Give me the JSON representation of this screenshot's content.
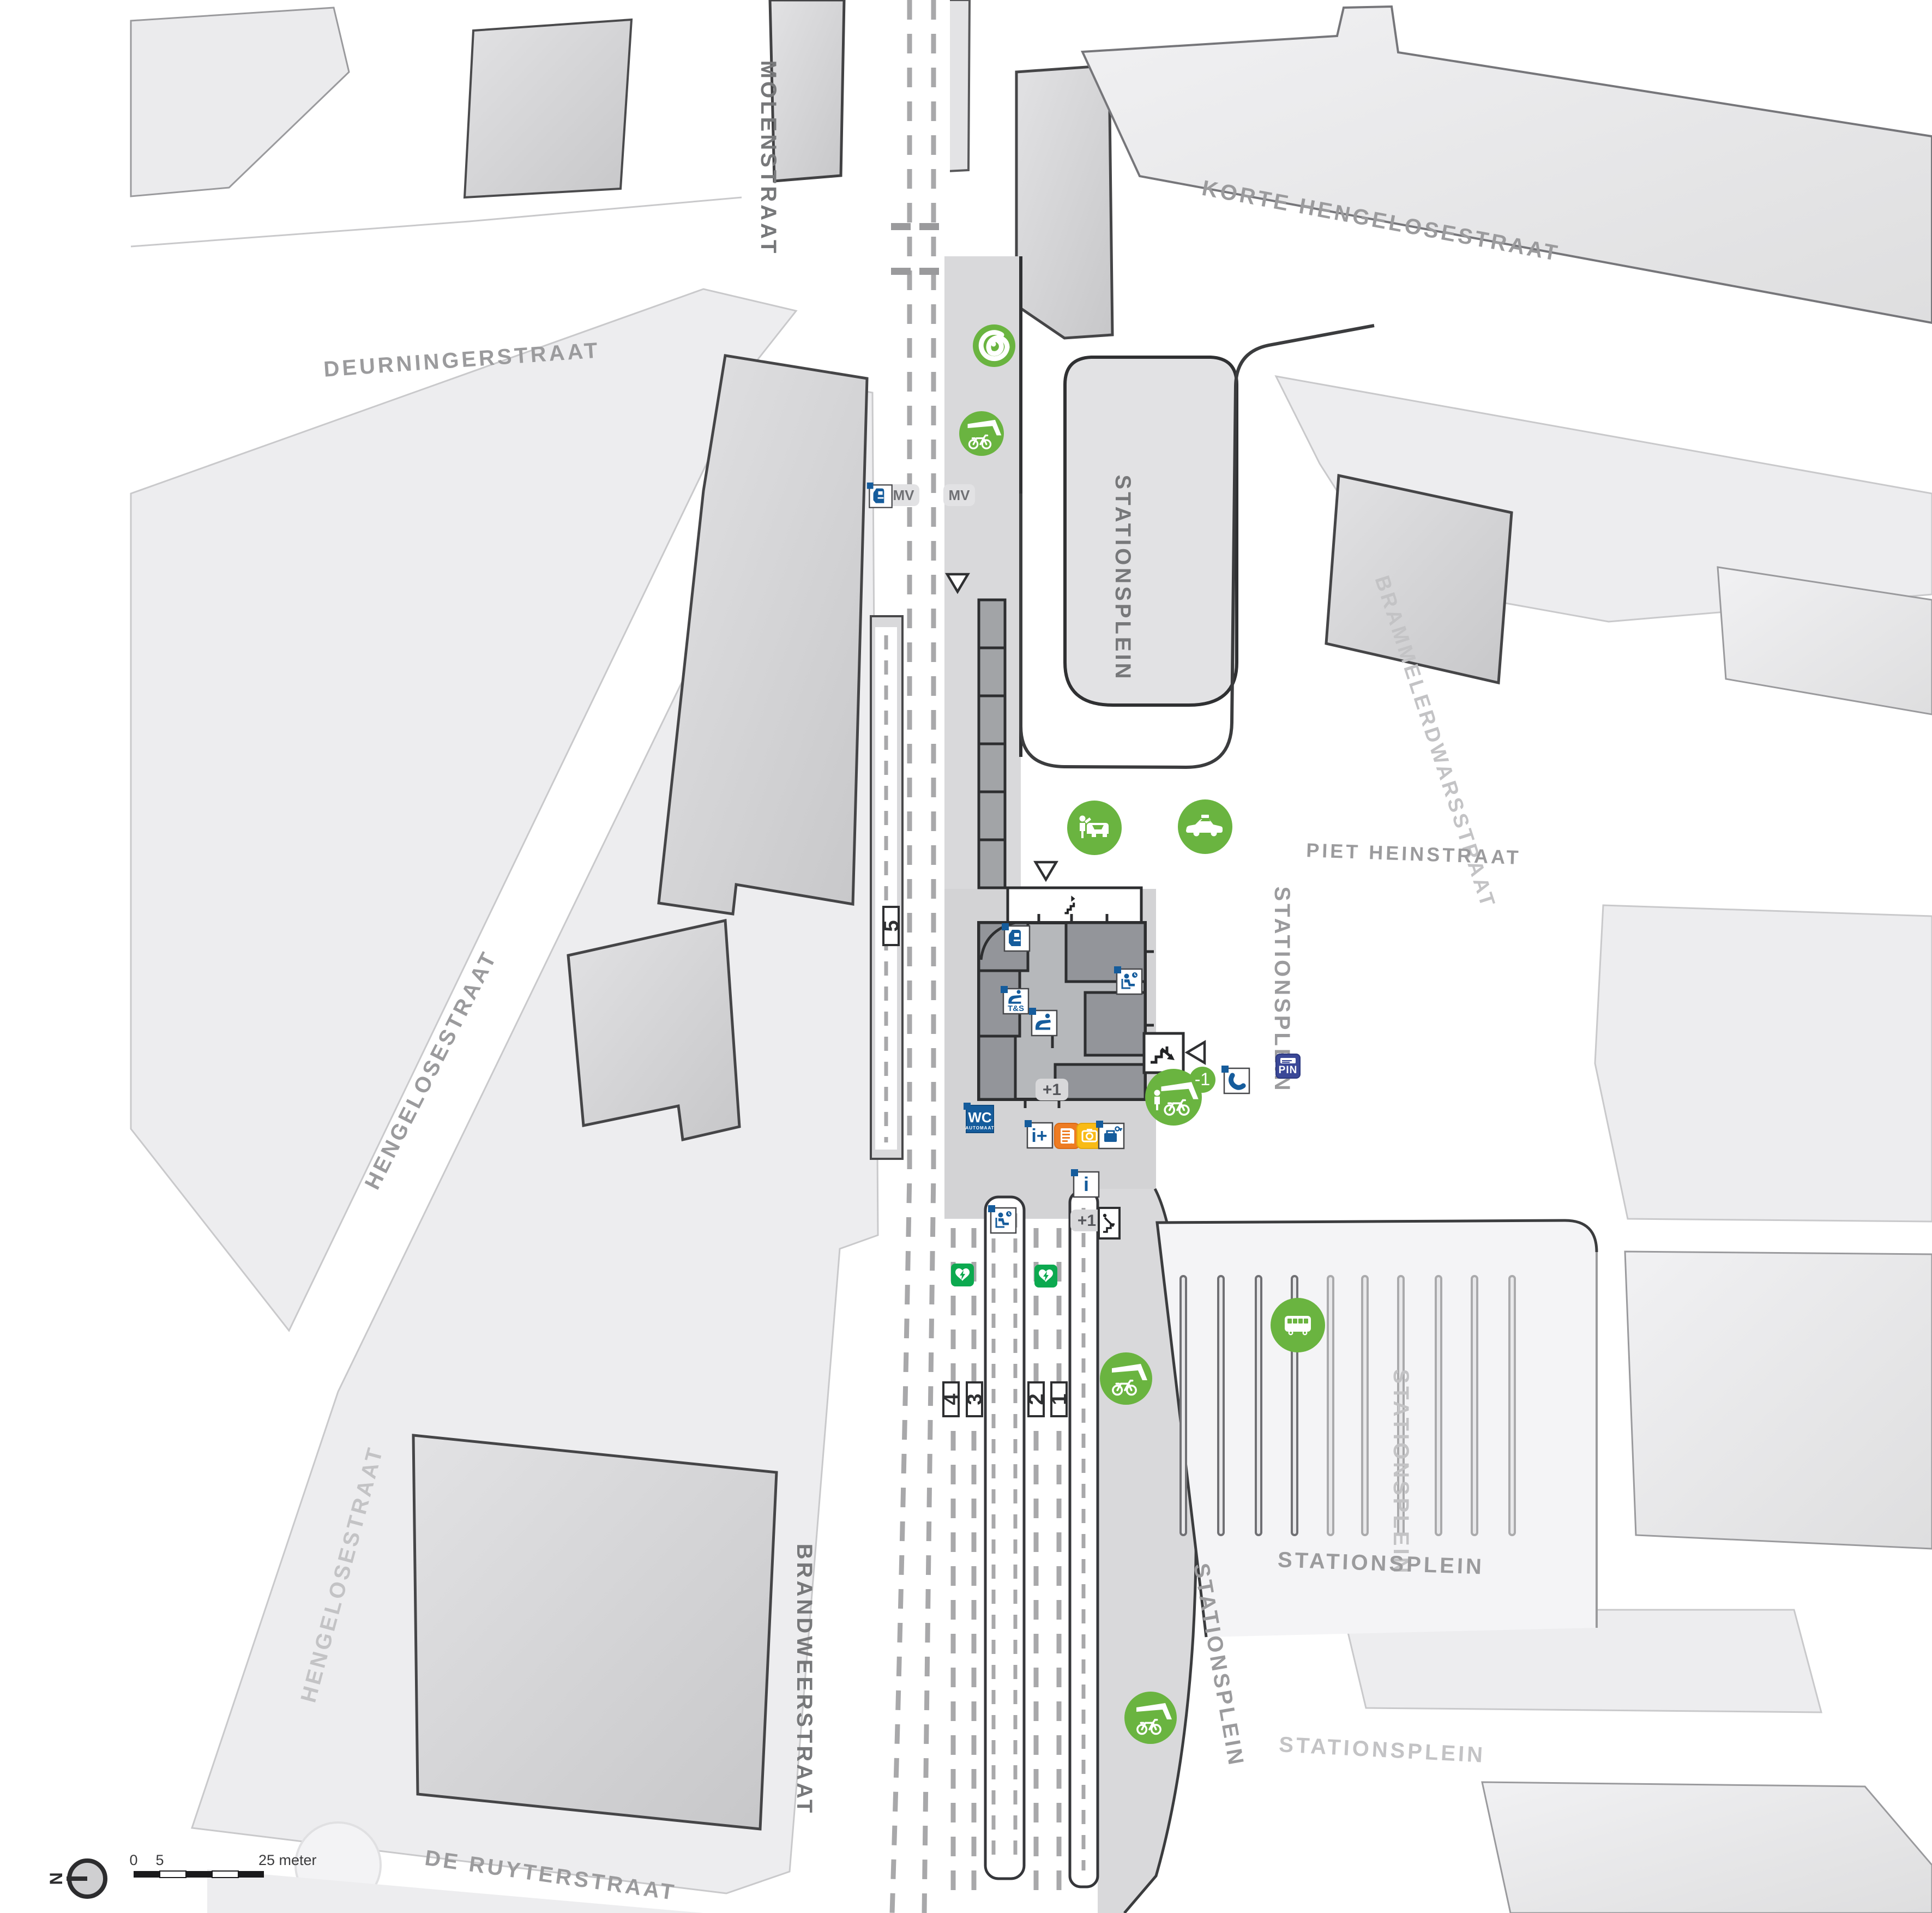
{
  "streets": [
    {
      "label": "MOLENSTRAAT"
    },
    {
      "label": "KORTE HENGELOSESTRAAT"
    },
    {
      "label": "DEURNINGERSTRAAT"
    },
    {
      "label": "HENGELOSESTRAAT"
    },
    {
      "label": "HENGELOSESTRAAT"
    },
    {
      "label": "BRAMMELERDWARSSTRAAT"
    },
    {
      "label": "PIET HEINSTRAAT"
    },
    {
      "label": "BRANDWEERSTRAAT"
    },
    {
      "label": "DE RUYTERSTRAAT"
    },
    {
      "label": "STATIONSPLEIN"
    },
    {
      "label": "STATIONSPLEIN"
    },
    {
      "label": "STATIONSPLEIN"
    },
    {
      "label": "STATIONSPLEIN"
    },
    {
      "label": "STATIONSPLEIN"
    },
    {
      "label": "STATIONSPLEIN"
    }
  ],
  "platforms": {
    "p1": "1",
    "p2": "2",
    "p3": "3",
    "p4": "4",
    "p5": "5"
  },
  "levels": {
    "station_hall_up": "+1",
    "platform_up": "+1",
    "bike_basement": "-1"
  },
  "labels": {
    "mv_left": "MV",
    "mv_right": "MV",
    "wc": "WC",
    "wc_sub": "AUTOMAAT",
    "tickets_service": "T&S",
    "info_plus": "i+",
    "info": "i",
    "atm": "PIN"
  },
  "scalebar": {
    "zero": "0",
    "five": "5",
    "max": "25 meter",
    "north": "N"
  },
  "colors": {
    "green": "#6ab440",
    "aed_green": "#0ca94f",
    "picto_blue": "#155c9c",
    "kiosk_orange": "#ee7c23",
    "photo_yellow": "#f9bb16",
    "atm_navy": "#3b4897"
  },
  "icon_semantics": {
    "greenwheels": "car-sharing location",
    "covered_bike_parking": "covered bicycle parking",
    "guarded_bike_parking": "guarded bicycle parking, level -1",
    "kiss_and_ride": "kiss and ride drop-off",
    "taxi": "taxi stand",
    "bus": "bus station",
    "ticket_machine": "ticket vending machine",
    "tickets_service": "tickets and service desk",
    "service_desk": "service counter",
    "waiting_room": "waiting area",
    "toilet": "self-service toilet",
    "kiosk": "newspaper kiosk",
    "photo_booth": "photo booth",
    "lockers": "luggage lockers",
    "atm": "cash machine",
    "phone": "public telephone",
    "aed": "defibrillator",
    "escalator": "escalator",
    "stairs": "stairs",
    "entrance": "entrance arrow"
  }
}
